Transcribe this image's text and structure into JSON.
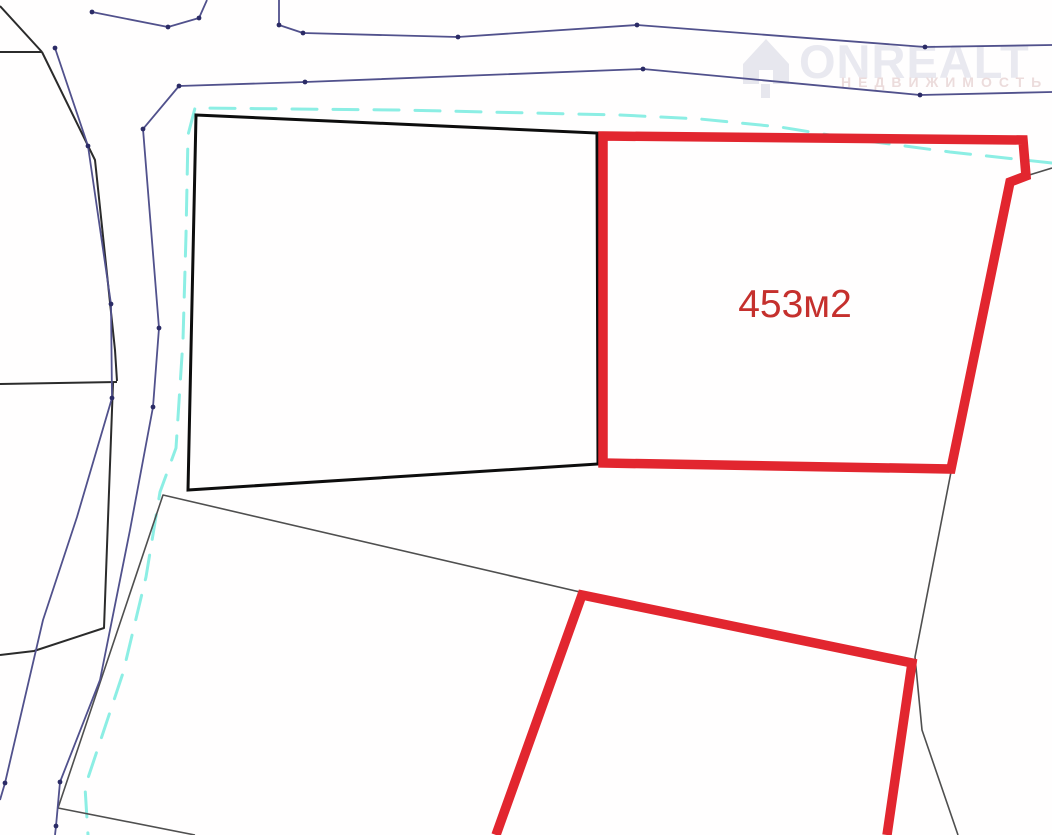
{
  "watermark": {
    "brand": "ONREALT",
    "subtitle": "НЕДВИЖИМОСТЬ",
    "brand_color": "#e9e9f0",
    "subtitle_color": "#ecdcdc",
    "icon": "house-icon"
  },
  "map": {
    "area_label": "453м2",
    "area_label_color": "#c5302d",
    "colors": {
      "highlight_red": "#e2262f",
      "parcel_black": "#0d0d0d",
      "boundary_gray": "#4f4f4f",
      "road_blue": "#51518c",
      "vertex_dot_blue": "#2b2b66",
      "utility_cyan": "#8ceee4",
      "background": "#fffefe"
    },
    "paths": {
      "red_parcel_main": "603,136 1023,140 1026,176 1010,182 951,469 603,463",
      "red_parcel_bottom": "496,835 582,595 912,663 887,835",
      "black_parcel": "196,115 597,133 598,464 188,490",
      "bottom_parcel": "580,592 163,495 58,808 195,835",
      "topleft_seg_diagonal": "0,6 42,52",
      "topleft_seg_top": "0,52 42,52",
      "topleft_seg_right": "42,52 95,160 115,350 117,381",
      "topleft_seg_bottom": "117,382 0,384",
      "topleft_seg_lower": "113,383 104,628 34,651 0,655",
      "right_boundary_upper": "1013,180 1052,168",
      "right_boundary_lower": "951,472 915,657 922,730 958,835",
      "road_top_a": "92,12 168,27 199,18 207,0",
      "road_top_b": "279,0 279,25 303,33 458,37 637,25 925,47 1052,45",
      "road_main": "1052,92 920,95 643,69 305,82 179,86 143,129 159,328 153,407 130,530 100,680 60,782 56,826 55,835",
      "road_left": "55,48 88,146 111,304 112,398 77,517 43,620 5,783 0,800",
      "cyan_boundary": "1052,163 950,152 860,140 780,127 700,119 620,115 400,110 195,108 188,135 186,235 183,340 176,448 160,492 146,577 123,673 85,787 88,835"
    },
    "vertex_dots": [
      [
        92,
        12
      ],
      [
        168,
        27
      ],
      [
        199,
        18
      ],
      [
        279,
        25
      ],
      [
        303,
        33
      ],
      [
        458,
        37
      ],
      [
        637,
        25
      ],
      [
        925,
        47
      ],
      [
        920,
        95
      ],
      [
        643,
        69
      ],
      [
        305,
        82
      ],
      [
        179,
        86
      ],
      [
        143,
        129
      ],
      [
        159,
        328
      ],
      [
        153,
        407
      ],
      [
        60,
        782
      ],
      [
        56,
        826
      ],
      [
        55,
        48
      ],
      [
        88,
        146
      ],
      [
        111,
        304
      ],
      [
        112,
        398
      ],
      [
        5,
        783
      ]
    ]
  }
}
